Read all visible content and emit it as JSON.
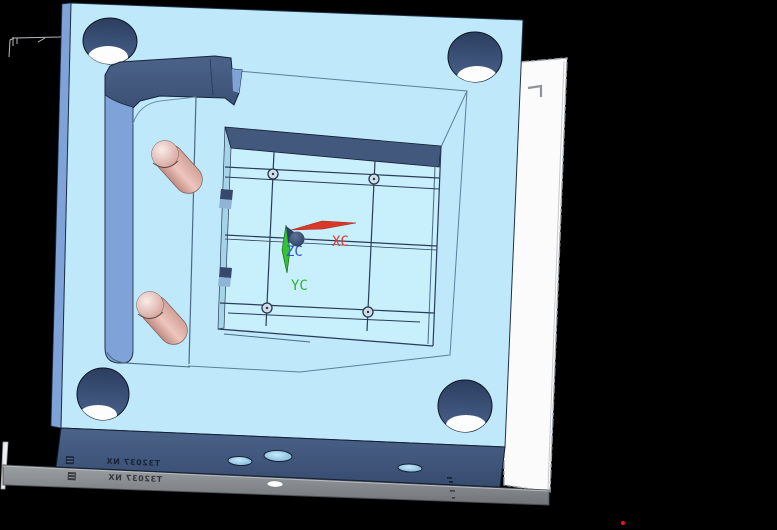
{
  "wcs": {
    "x_label": "XC",
    "y_label": "YC",
    "z_label": "ZC"
  },
  "stamp": {
    "text": "T32037 NX"
  },
  "colors": {
    "background": "#000000",
    "plate_face": "#bfe9fa",
    "plate_floor": "#c8effc",
    "plate_side": "#7fa3d8",
    "pocket_band": "#42587d",
    "pocket_wall": "#a5d4e8",
    "white_plate": "#fbfbfc",
    "gray_strip": "#8b9095",
    "axis_x": "#e03a30",
    "axis_y": "#2fb32c",
    "axis_z": "#2f55d4",
    "edge_line": "#1e2f49"
  }
}
